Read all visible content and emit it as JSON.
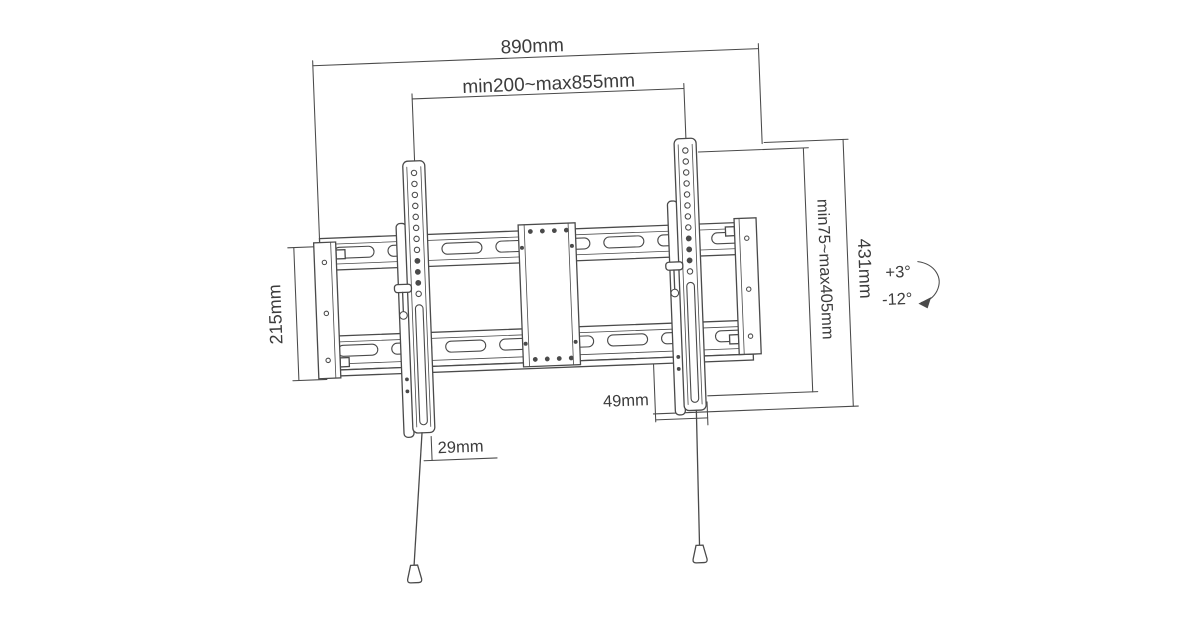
{
  "drawing": {
    "dimensions": {
      "total_width": "890mm",
      "mount_width_range": "min200~max855mm",
      "plate_height": "215mm",
      "mount_height_range": "min75~max405mm",
      "total_height": "431mm",
      "offset_bottom": "49mm",
      "offset_arm": "29mm"
    },
    "tilt": {
      "up": "+3°",
      "down": "-12°"
    }
  },
  "colors": {
    "line": "#4a4a4a",
    "text": "#3c3c3c",
    "background": "#ffffff"
  }
}
